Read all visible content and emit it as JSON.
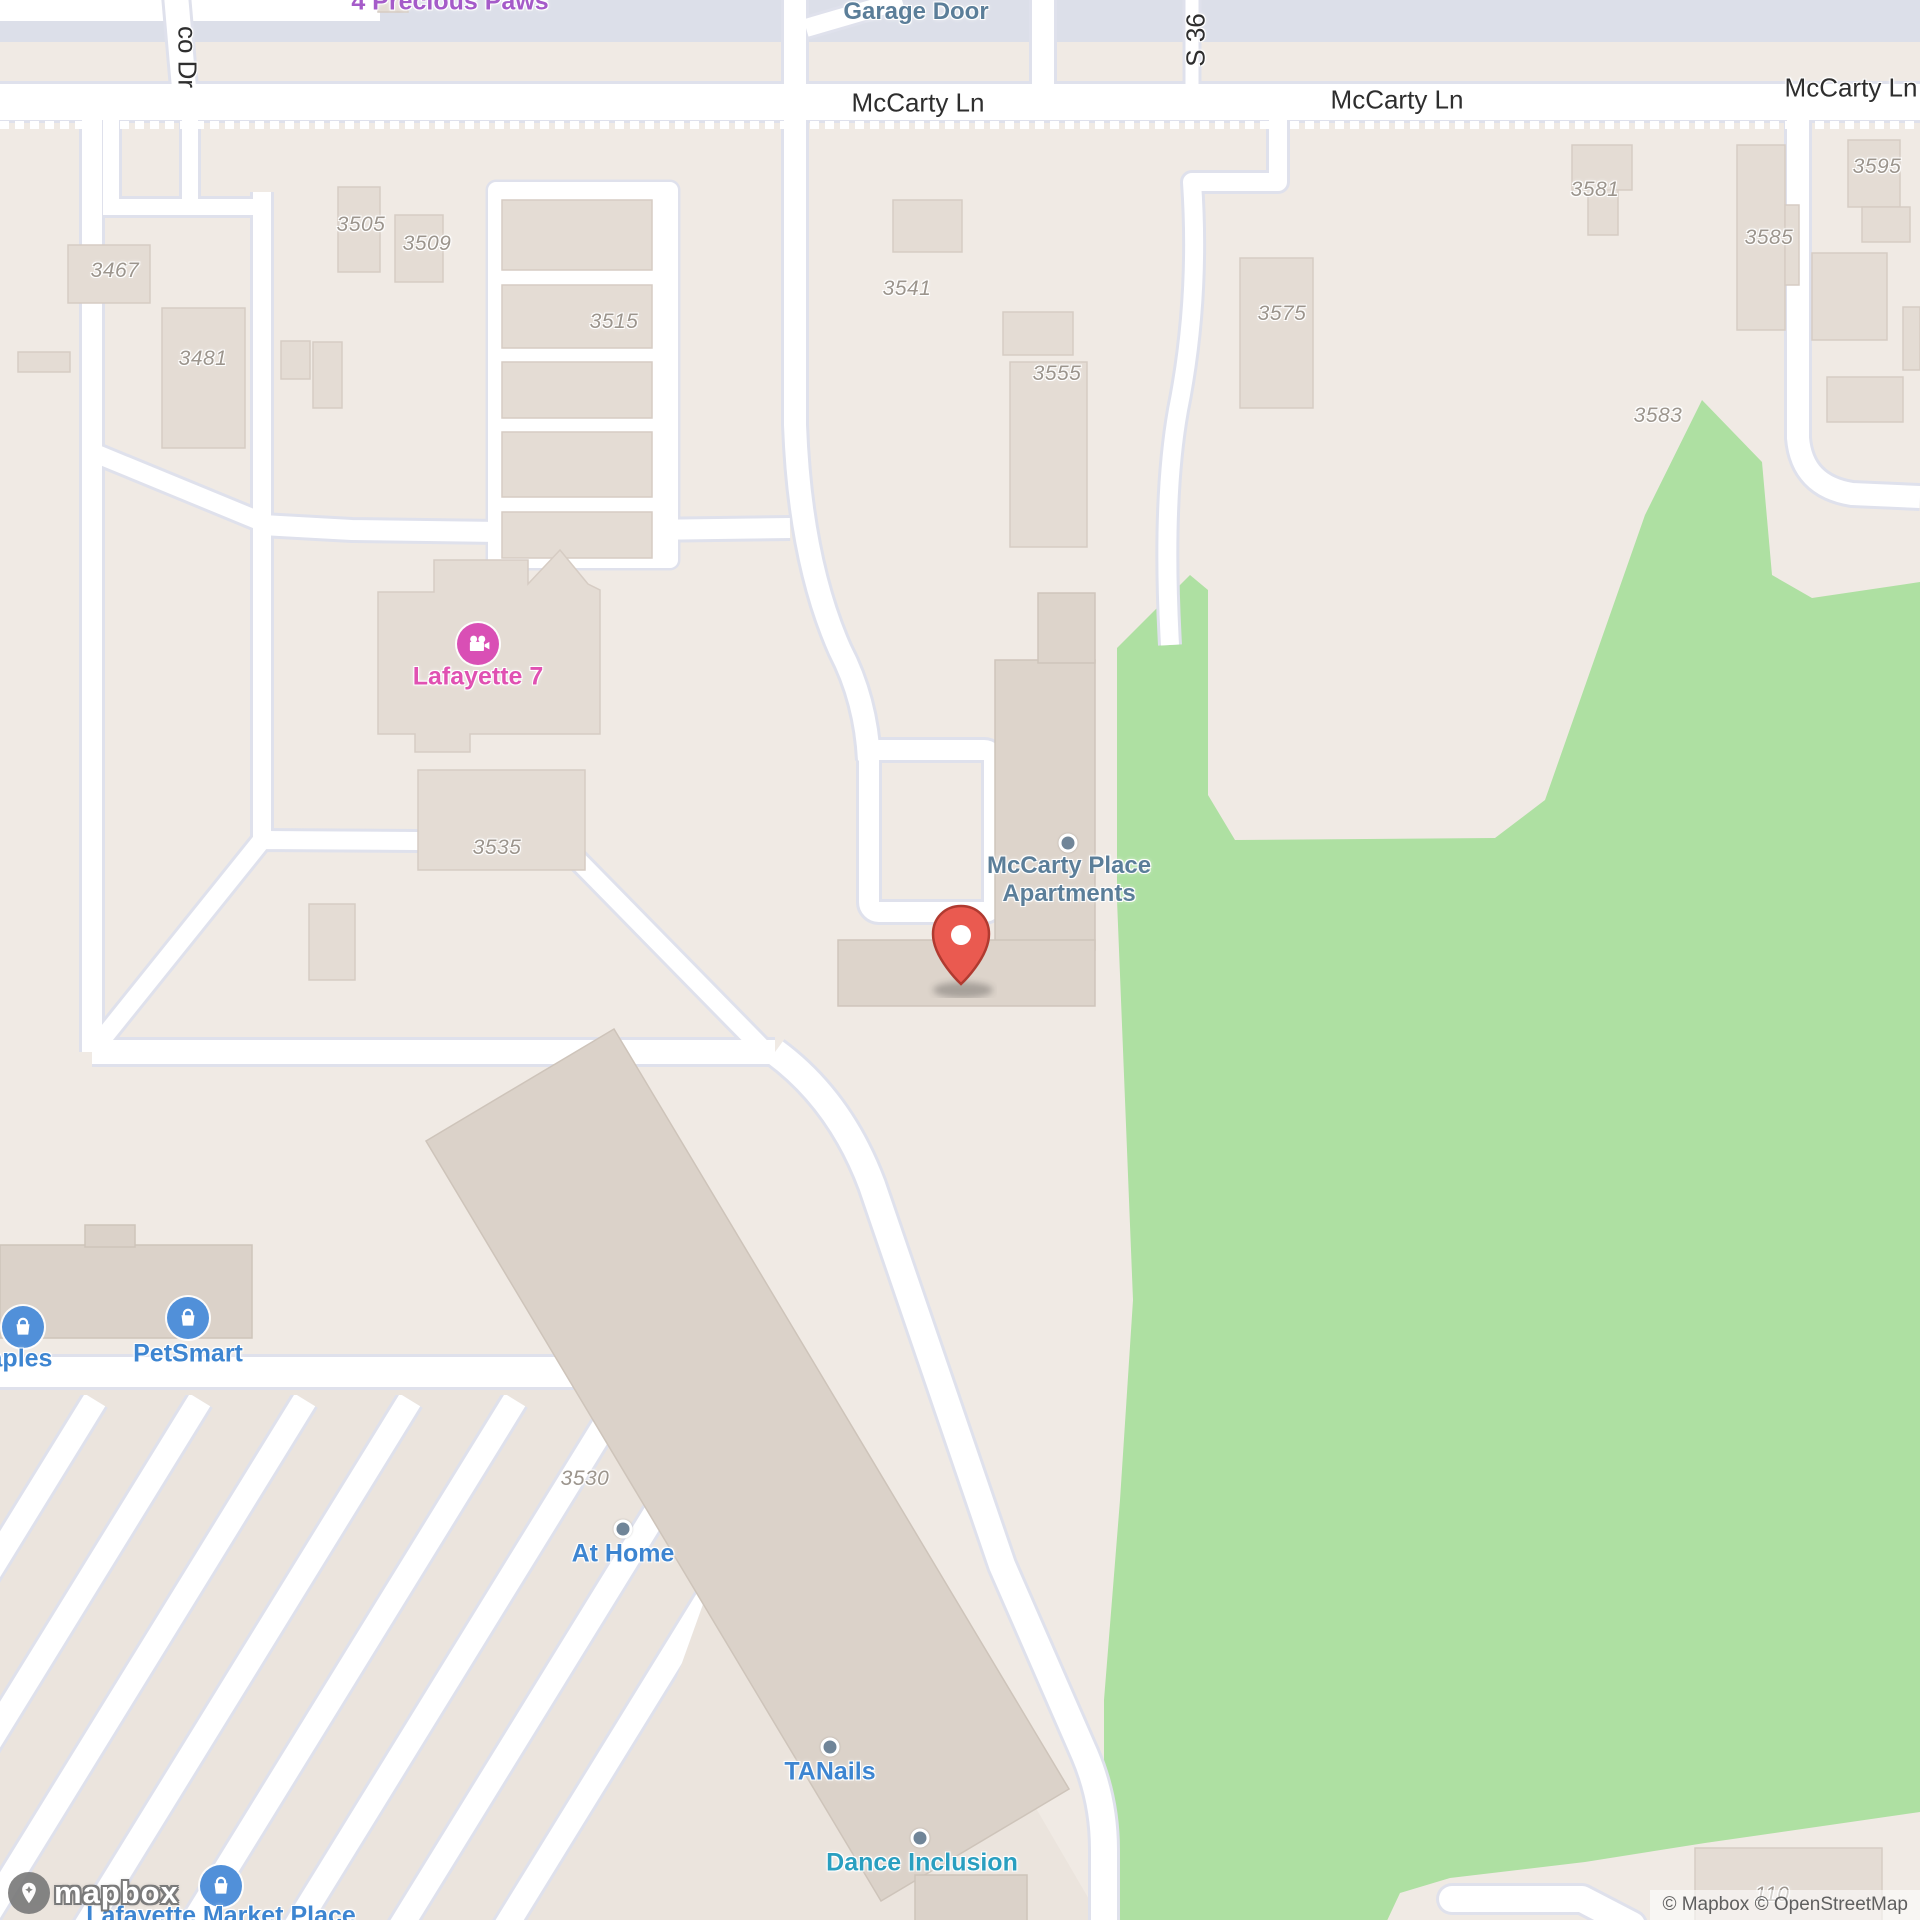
{
  "attribution": {
    "text": "© Mapbox © OpenStreetMap"
  },
  "logo": {
    "text": "mapbox"
  },
  "marker": {
    "name": "location-pin",
    "color": "#ea5a50"
  },
  "colors": {
    "background": "#f0eae4",
    "park_green": "#aee0a2",
    "road_white": "#ffffff",
    "road_casing": "#dfe1ec",
    "building": "#e4dcd4",
    "building_dark": "#dbd2c9",
    "commercial_band": "#dcdfe9",
    "poi_blue": "#3d85d1",
    "poi_teal": "#2a9fc0",
    "poi_pink": "#e051b2",
    "poi_purple": "#a55bc9",
    "place_slate": "#5b7e99",
    "address_gray": "#9c958d",
    "marker_red": "#ea5a50"
  },
  "labels": {
    "roads": [
      {
        "text": "McCarty Ln"
      },
      {
        "text": "McCarty Ln"
      },
      {
        "text": "McCarty Ln"
      },
      {
        "text": "co Dr"
      },
      {
        "text": "S 36"
      }
    ],
    "addresses": [
      {
        "text": "3467"
      },
      {
        "text": "3481"
      },
      {
        "text": "3505"
      },
      {
        "text": "3509"
      },
      {
        "text": "3515"
      },
      {
        "text": "3535"
      },
      {
        "text": "3541"
      },
      {
        "text": "3555"
      },
      {
        "text": "3575"
      },
      {
        "text": "3581"
      },
      {
        "text": "3583"
      },
      {
        "text": "3585"
      },
      {
        "text": "3595"
      },
      {
        "text": "3530"
      },
      {
        "text": "110"
      }
    ],
    "pois": [
      {
        "text": "Garage Door"
      },
      {
        "text": "4 Precious Paws"
      },
      {
        "text": "Lafayette 7"
      },
      {
        "text": "McCarty Place"
      },
      {
        "text": "Apartments"
      },
      {
        "text": "PetSmart"
      },
      {
        "text": "Staples"
      },
      {
        "text": "At Home"
      },
      {
        "text": "TANails"
      },
      {
        "text": "Dance Inclusion"
      },
      {
        "text": "Lafayette Market Place"
      }
    ]
  }
}
